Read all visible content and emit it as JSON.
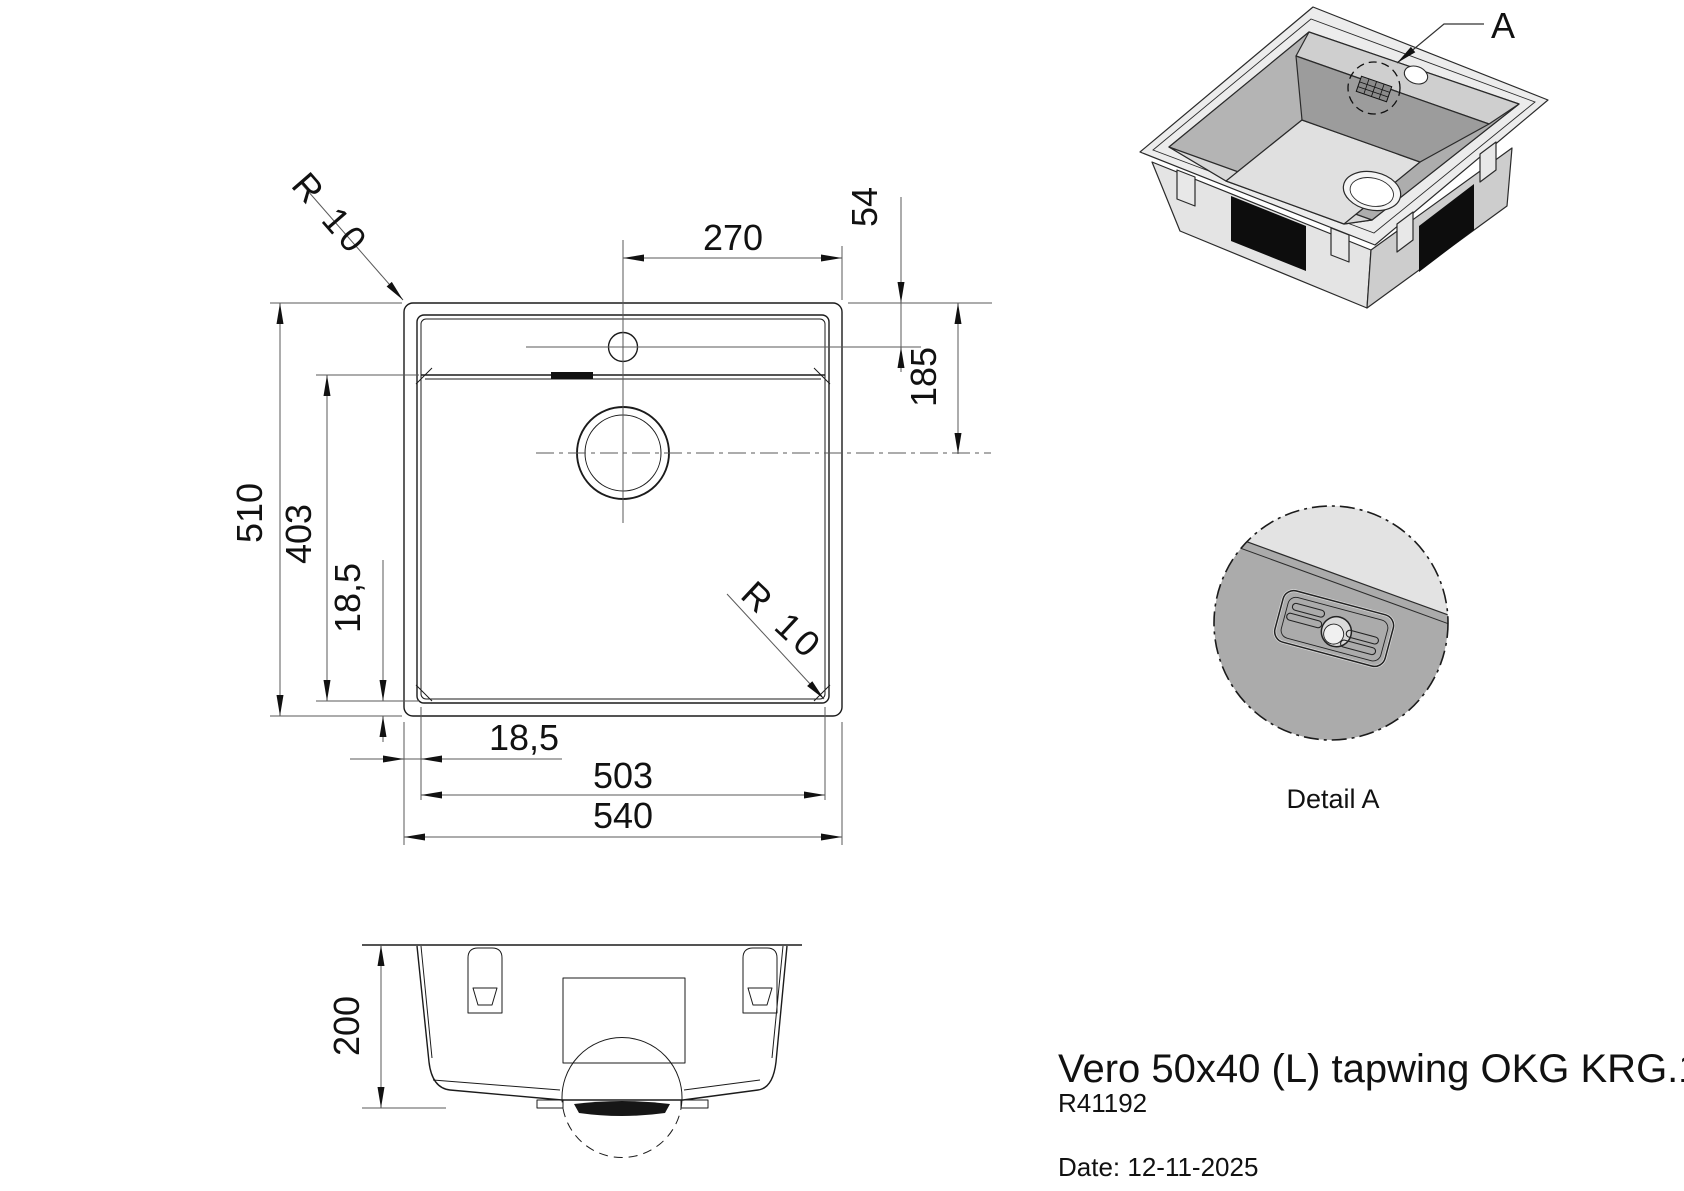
{
  "title_block": {
    "product_name": "Vero 50x40 (L) tapwing OKG KRG.1",
    "article_code": "R41192",
    "date": "Date: 12-11-2025"
  },
  "views": {
    "detail": {
      "label": "Detail A",
      "callout": "A"
    }
  },
  "dimensions": {
    "overall_width": "540",
    "bowl_width": "503",
    "overall_depth": "510",
    "bowl_depth": "403",
    "rim_offset_bottom": "18,5",
    "rim_offset_left": "18,5",
    "tap_hole_offset_x": "270",
    "tap_hole_offset_y": "54",
    "top_to_drain": "185",
    "body_height": "200",
    "corner_radius_outer": "R 10",
    "corner_radius_bowl": "R 10"
  },
  "colors": {
    "line": "#1b1b1b",
    "surface_light": "#e3e3e3",
    "surface_mid": "#c6c6c6",
    "surface_dark": "#a0a0a0",
    "pad": "#0d0d0d"
  }
}
